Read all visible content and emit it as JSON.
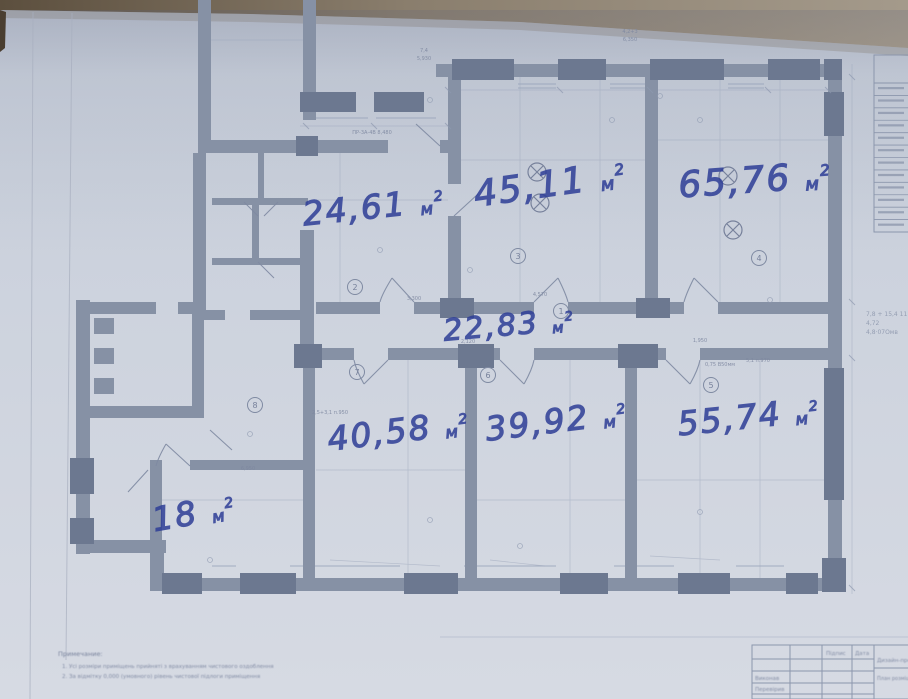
{
  "photo": {
    "description": "Photographed blueprint floor plan with handwritten room areas",
    "backdrop_color_left": "#5c4f3e",
    "backdrop_color_right": "#a49a8b",
    "paper_color_top": "#bfc6d3",
    "paper_color_bottom": "#d6dae3",
    "wall_color": "#8691a5",
    "pier_color": "#6c7890",
    "line_color": "#9aa5b9",
    "ink_color": "#2e3e97",
    "print_text_color": "#7e88a0"
  },
  "rooms": [
    {
      "marker": "2",
      "area": "24,61",
      "unit": "м",
      "sup": "2",
      "x": 375,
      "y": 218,
      "rot": -6,
      "size": 33
    },
    {
      "marker": "3",
      "area": "45,11",
      "unit": "м",
      "sup": "2",
      "x": 552,
      "y": 196,
      "rot": -8,
      "size": 36
    },
    {
      "marker": "4",
      "area": "65,76",
      "unit": "м",
      "sup": "2",
      "x": 756,
      "y": 192,
      "rot": -4,
      "size": 36
    },
    {
      "marker": "1",
      "area": "22,83",
      "unit": "м",
      "sup": "2",
      "x": 510,
      "y": 335,
      "rot": -5,
      "size": 30
    },
    {
      "marker": "7",
      "area": "40,58",
      "unit": "м",
      "sup": "2",
      "x": 400,
      "y": 442,
      "rot": -7,
      "size": 33
    },
    {
      "marker": "6",
      "area": "39,92",
      "unit": "м",
      "sup": "2",
      "x": 558,
      "y": 432,
      "rot": -7,
      "size": 33
    },
    {
      "marker": "5",
      "area": "55,74",
      "unit": "м",
      "sup": "2",
      "x": 750,
      "y": 428,
      "rot": -6,
      "size": 33
    },
    {
      "marker": "8",
      "area": "18",
      "unit": "м",
      "sup": "2",
      "x": 196,
      "y": 524,
      "rot": -10,
      "size": 33
    }
  ],
  "room_markers": [
    {
      "n": "1",
      "x": 561,
      "y": 311
    },
    {
      "n": "2",
      "x": 355,
      "y": 287
    },
    {
      "n": "3",
      "x": 518,
      "y": 256
    },
    {
      "n": "4",
      "x": 759,
      "y": 258
    },
    {
      "n": "5",
      "x": 711,
      "y": 385
    },
    {
      "n": "6",
      "x": 488,
      "y": 375
    },
    {
      "n": "7",
      "x": 357,
      "y": 372
    },
    {
      "n": "8",
      "x": 255,
      "y": 405
    }
  ],
  "lamps": [
    {
      "x": 537,
      "y": 172
    },
    {
      "x": 540,
      "y": 203
    },
    {
      "x": 728,
      "y": 176
    },
    {
      "x": 733,
      "y": 230
    }
  ],
  "dim_labels": [
    {
      "t": "4,2+3",
      "x": 630,
      "y": 33
    },
    {
      "t": "6,350",
      "x": 630,
      "y": 41
    },
    {
      "t": "7,4",
      "x": 424,
      "y": 52
    },
    {
      "t": "5,930",
      "x": 424,
      "y": 60
    },
    {
      "t": "ПР-3А-4В 8,480",
      "x": 372,
      "y": 134
    },
    {
      "t": "4,570",
      "x": 540,
      "y": 296
    },
    {
      "t": "2,120",
      "x": 468,
      "y": 343
    },
    {
      "t": "1,950",
      "x": 700,
      "y": 342
    },
    {
      "t": "3,300",
      "x": 414,
      "y": 300
    },
    {
      "t": "6,950",
      "x": 248,
      "y": 470
    },
    {
      "t": "2,5+3,1 п.950",
      "x": 330,
      "y": 414
    },
    {
      "t": "5,1 п.970",
      "x": 758,
      "y": 362
    },
    {
      "t": "0,75 В50мм",
      "x": 720,
      "y": 366
    }
  ],
  "margin_notes": {
    "x": 866,
    "y": 316,
    "lines": [
      "7,8 + 15,4 11",
      "4,72",
      "4,8·07Омв"
    ]
  },
  "notes": {
    "title": "Примечание:",
    "items": [
      "1. Усі розміри приміщень прийняті з врахуванням чистового оздоблення",
      "2. За відмітку 0,000 (умовного) рівень чистової підлоги приміщення"
    ]
  },
  "title_block": {
    "col_signature": "Підпис",
    "col_date": "Дата",
    "row_author": "Виконав",
    "row_checker": "Перевірив",
    "project": "Дизайн-проект",
    "sheet": "План розміщення прим."
  },
  "legend": {
    "row_count": 12
  }
}
